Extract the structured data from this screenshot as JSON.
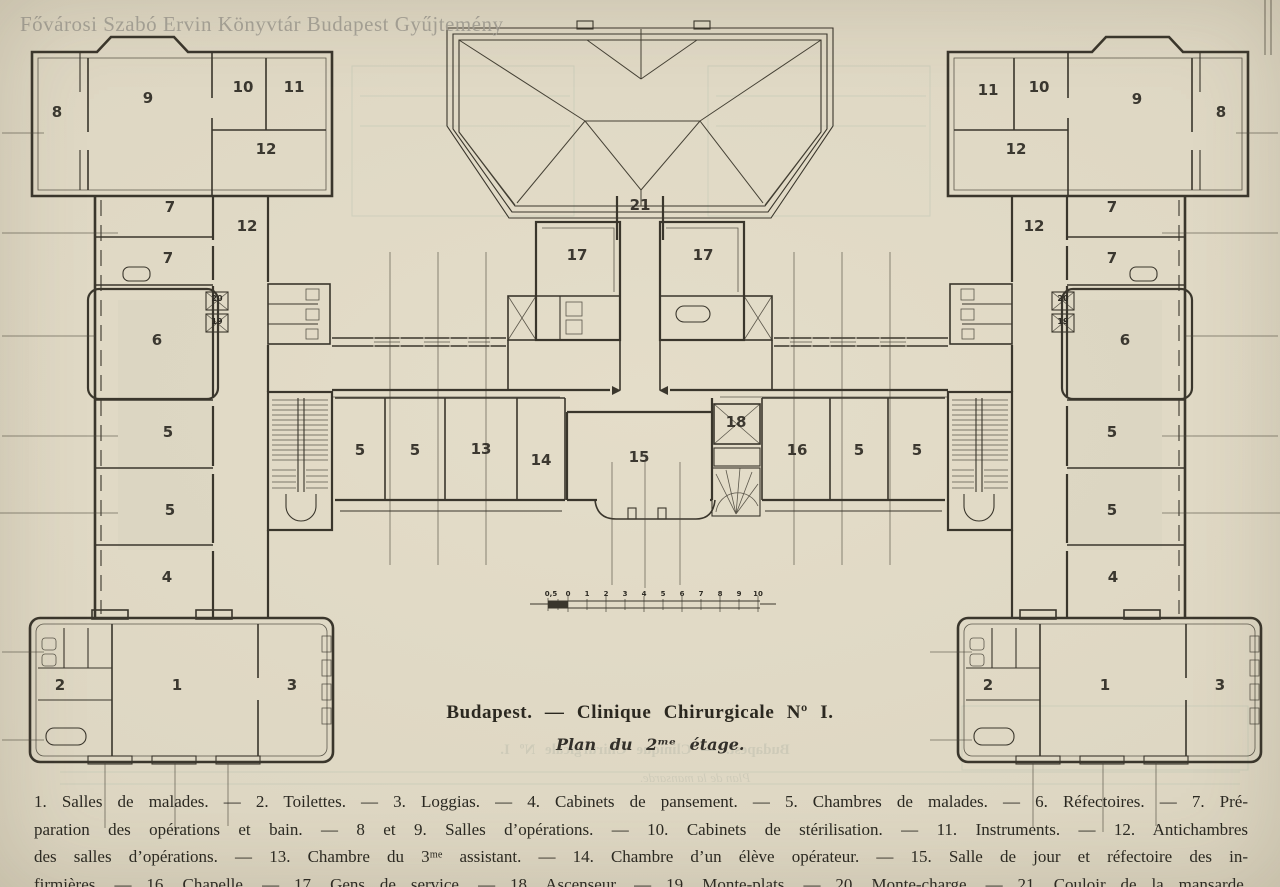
{
  "watermark": "Fővárosi Szabó Ervin Könyvtár Budapest Gyűjtemény",
  "title": {
    "main": "Budapest.  —  Clinique Chirurgicale Nº I.",
    "sub": "Plan du 2ᵐᵉ étage."
  },
  "ghost": {
    "line1": "Budapest. — Clinique Chirurgicale Nº I.",
    "line2": "Plan de la mansarde."
  },
  "legend": {
    "lines": [
      "1. Salles de malades. — 2. Toilettes. — 3. Loggias. — 4. Cabinets de pansement. — 5. Chambres de malades. — 6. Réfectoires. — 7. Pré-",
      "paration des opérations et bain. — 8 et 9. Salles d’opérations. — 10. Cabinets de stérilisation. — 11. Instruments. — 12. Antichambres",
      "des salles d’opérations. — 13. Chambre du 3ᵐᵉ assistant. — 14. Chambre d’un élève opérateur. — 15. Salle de jour et réfectoire des in-",
      "firmières. — 16. Chapelle. — 17. Gens de service. — 18. Ascenseur. — 19. Monte-plats. — 20. Monte-charge. — 21. Couloir de la mansarde."
    ]
  },
  "scale": {
    "ticks": [
      "0,5",
      "0",
      "1",
      "2",
      "3",
      "4",
      "5",
      "6",
      "7",
      "8",
      "9",
      "10"
    ]
  },
  "plan": {
    "rooms": [
      {
        "label": "8",
        "x": 57,
        "y": 117
      },
      {
        "label": "9",
        "x": 148,
        "y": 103
      },
      {
        "label": "10",
        "x": 243,
        "y": 92
      },
      {
        "label": "11",
        "x": 294,
        "y": 92
      },
      {
        "label": "12",
        "x": 266,
        "y": 154
      },
      {
        "label": "7",
        "x": 170,
        "y": 212
      },
      {
        "label": "12",
        "x": 247,
        "y": 231
      },
      {
        "label": "7",
        "x": 168,
        "y": 263
      },
      {
        "label": "6",
        "x": 157,
        "y": 345
      },
      {
        "label": "5",
        "x": 168,
        "y": 437
      },
      {
        "label": "5",
        "x": 170,
        "y": 515
      },
      {
        "label": "4",
        "x": 167,
        "y": 582
      },
      {
        "label": "2",
        "x": 60,
        "y": 690
      },
      {
        "label": "1",
        "x": 177,
        "y": 690
      },
      {
        "label": "3",
        "x": 292,
        "y": 690
      },
      {
        "label": "21",
        "x": 640,
        "y": 210
      },
      {
        "label": "17",
        "x": 577,
        "y": 260
      },
      {
        "label": "17",
        "x": 703,
        "y": 260
      },
      {
        "label": "5",
        "x": 360,
        "y": 455
      },
      {
        "label": "5",
        "x": 415,
        "y": 455
      },
      {
        "label": "13",
        "x": 481,
        "y": 454
      },
      {
        "label": "14",
        "x": 541,
        "y": 465
      },
      {
        "label": "15",
        "x": 639,
        "y": 462
      },
      {
        "label": "18",
        "x": 736,
        "y": 427
      },
      {
        "label": "16",
        "x": 797,
        "y": 455
      },
      {
        "label": "5",
        "x": 859,
        "y": 455
      },
      {
        "label": "5",
        "x": 917,
        "y": 455
      },
      {
        "label": "12",
        "x": 1034,
        "y": 231
      },
      {
        "label": "7",
        "x": 1112,
        "y": 212
      },
      {
        "label": "7",
        "x": 1112,
        "y": 263
      },
      {
        "label": "6",
        "x": 1125,
        "y": 345
      },
      {
        "label": "5",
        "x": 1112,
        "y": 437
      },
      {
        "label": "5",
        "x": 1112,
        "y": 515
      },
      {
        "label": "4",
        "x": 1113,
        "y": 582
      },
      {
        "label": "11",
        "x": 988,
        "y": 95
      },
      {
        "label": "10",
        "x": 1039,
        "y": 92
      },
      {
        "label": "9",
        "x": 1137,
        "y": 104
      },
      {
        "label": "8",
        "x": 1221,
        "y": 117
      },
      {
        "label": "12",
        "x": 1016,
        "y": 154
      },
      {
        "label": "2",
        "x": 988,
        "y": 690
      },
      {
        "label": "1",
        "x": 1105,
        "y": 690
      },
      {
        "label": "3",
        "x": 1220,
        "y": 690
      }
    ],
    "shafts": [
      {
        "label": "20",
        "x": 217,
        "y": 301
      },
      {
        "label": "19",
        "x": 217,
        "y": 324
      },
      {
        "label": "20",
        "x": 1063,
        "y": 301
      },
      {
        "label": "19",
        "x": 1063,
        "y": 324
      }
    ]
  },
  "colors": {
    "paper": "#ddd6c2",
    "ink": "#3a362c",
    "bleed": "#a8b8a8",
    "watermark": "#a5a196"
  }
}
